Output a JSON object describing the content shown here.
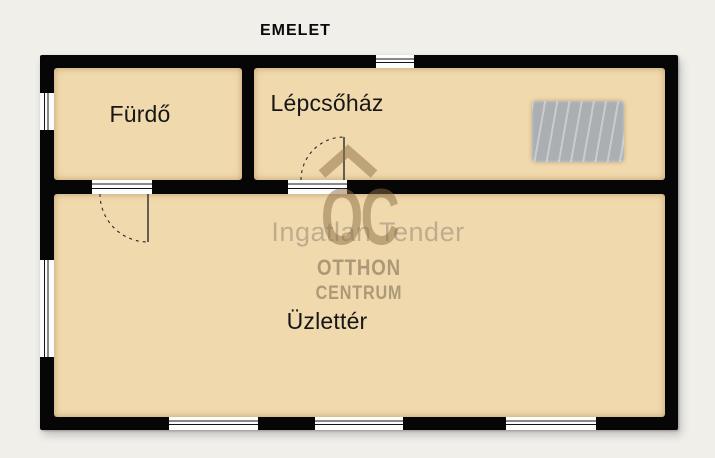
{
  "page": {
    "title": "EMELET"
  },
  "floor_plan": {
    "rooms": [
      {
        "id": "furdo",
        "label": "Fürdő"
      },
      {
        "id": "lepcsohaz",
        "label": "Lépcsőház"
      },
      {
        "id": "uzletter",
        "label": "Üzlettér"
      }
    ]
  },
  "watermark": {
    "overlay_text": "Ingatlan Tender",
    "logo_monogram": "OC",
    "brand_line1": "OTTHON",
    "brand_line2": "CENTRUM"
  },
  "colors": {
    "page_bg": "#f0efea",
    "wall": "#060606",
    "room_fill": "#f0d9ac",
    "stairs_fill": "#b2b6b9",
    "brand_brown": "#8c6e46",
    "watermark_gray": "#787068"
  }
}
